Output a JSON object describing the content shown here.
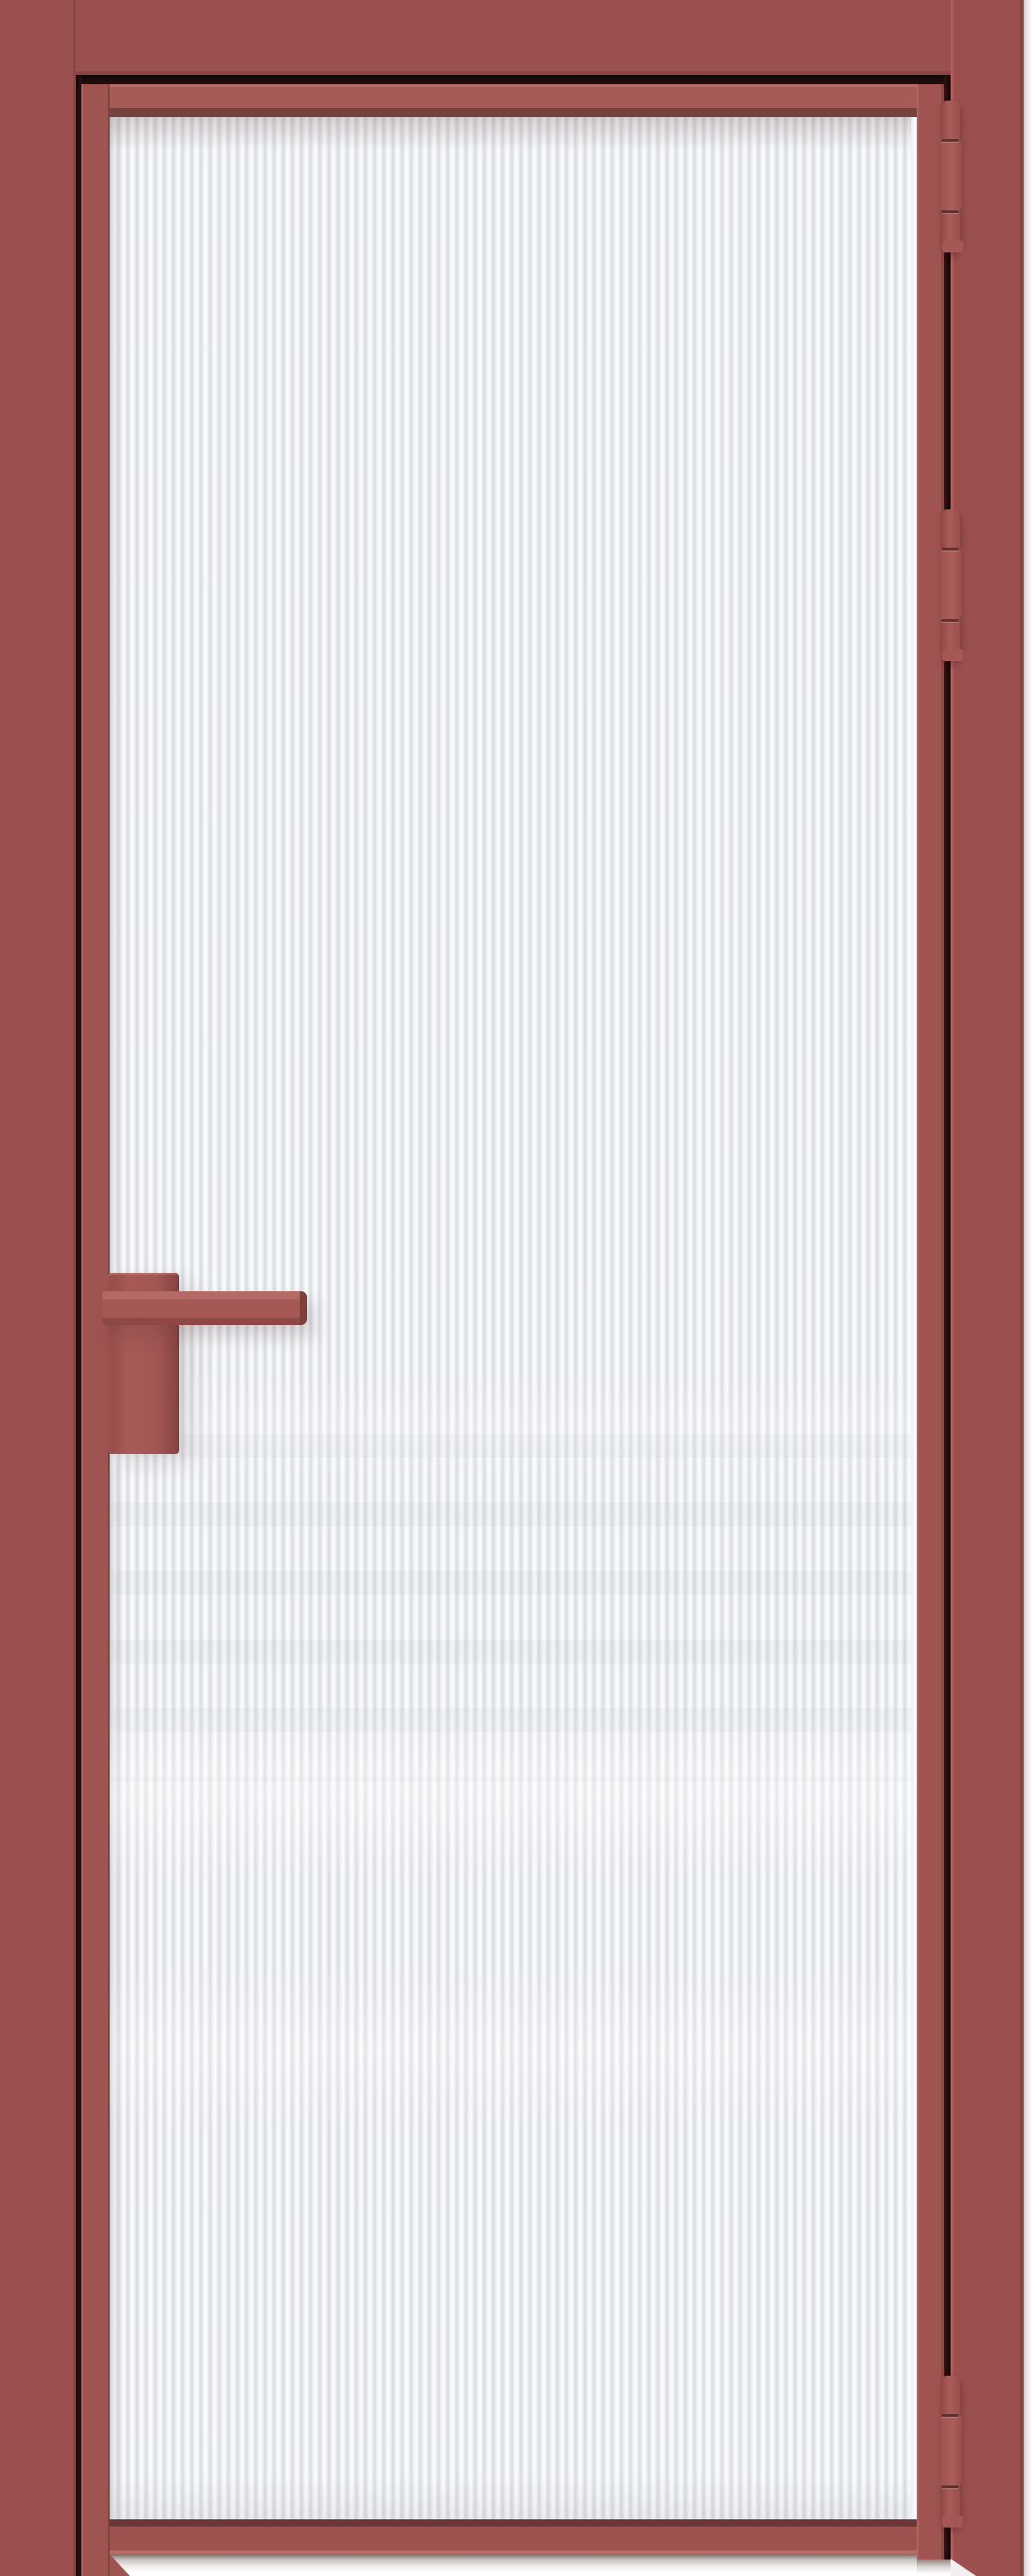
{
  "image": {
    "subject": "Interior door product render",
    "description": "Closed aluminium-framed interior door with a full-height vertical fluted (reeded) translucent glass panel; matte antique-red frame and hardware; three hinges on the right jamb; square lever handle on a tall rectangular backplate on the left stile; white background strip along the right edge and floor clearance gap below the leaf",
    "visible_text": ""
  },
  "parts": {
    "casing": "Door frame casing (head, left jamb, right jamb)",
    "leaf": "Door leaf with aluminium stiles and rails",
    "glass": "Fluted reeded glass panel",
    "top_rail": "Leaf top rail",
    "bottom_rail": "Leaf bottom rail",
    "left_stile": "Leaf left stile",
    "right_stile": "Leaf right stile",
    "hinges": [
      "Top hinge",
      "Upper-middle hinge",
      "Bottom hinge"
    ],
    "handle_lever": "Square lever handle",
    "handle_backplate": "Rectangular handle backplate",
    "floor_gap": "Floor clearance gap under leaf",
    "wall_edge": "Background wall edge strip"
  },
  "colors": {
    "bg": "#ffffff",
    "red-casing": "#9b504f",
    "red-stile": "#a05452",
    "red-rail": "#a75b58",
    "red-highlight": "#b66c67",
    "red-shadow": "#774140",
    "red-deep": "#6d3735",
    "gap-dark": "#1a0c0b",
    "hinge-red": "#a65a57",
    "hinge-groove": "#5f302e",
    "handle-red": "#a35753",
    "glass-base": "#eef0f3",
    "glass-groove": "#d8dbe0",
    "glass-light": "#fcfdfe",
    "edge-strip": "#eceae9",
    "floor-shadow": "#7c6b68"
  }
}
